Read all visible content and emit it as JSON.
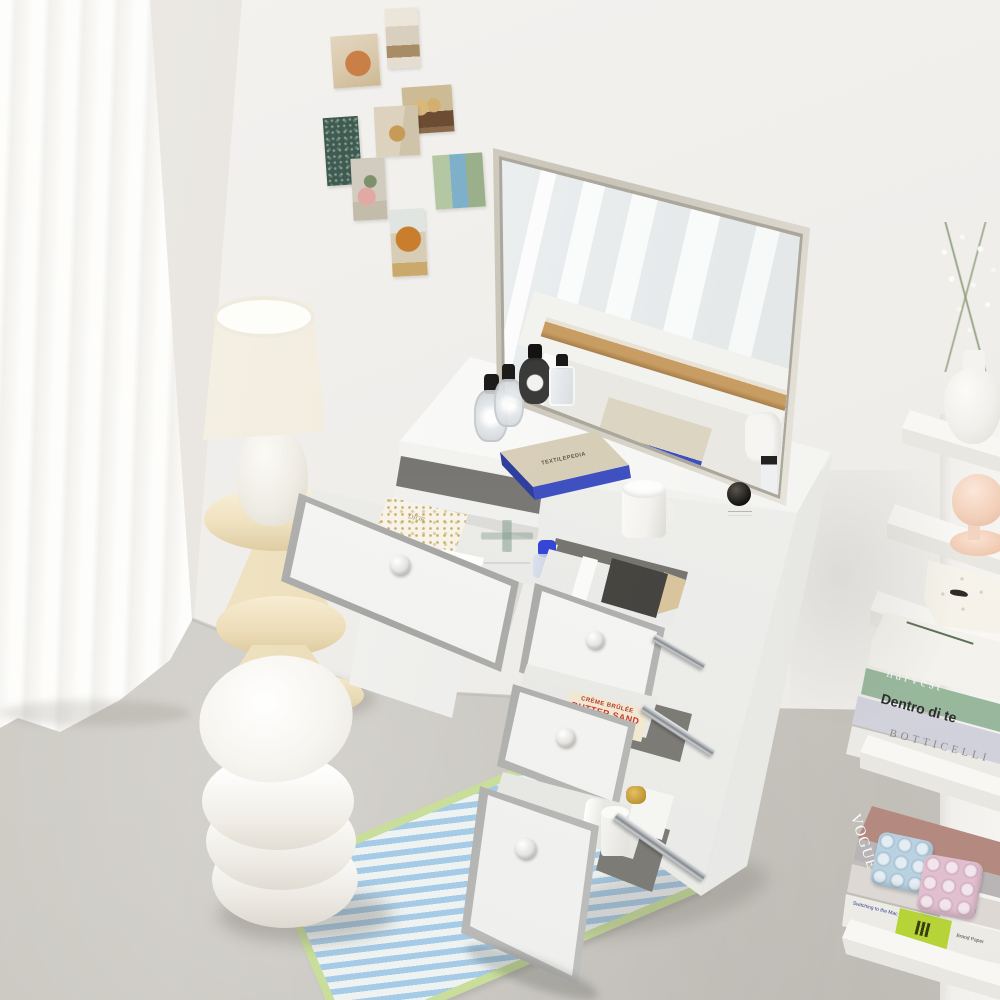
{
  "subject": "bright room corner with white vanity dressing table, tilted mirror, four open drawers, boucle stool, cream lamp on pedestal side table, striped rug and white wall shelf with books",
  "palette": {
    "wall": "#f1efec",
    "wall_left": "#e8e5e1",
    "floor": "#ccc9c2",
    "curtain": "#fbfaf8",
    "desk_white": "#f7f7f5",
    "chrome_trim": "#b0b1af",
    "drawer_slot_dark": "#76756f",
    "pedestal_cream": "#f0e5c6",
    "rug_blue": "#a6cbe6",
    "rug_green": "#c8de9a",
    "page_edge_blue": "#3f51c0",
    "candle_lid_green": "#34534a",
    "bottle_cap_black": "#1c1b19",
    "vogue_gray": "#c7c2c4",
    "lime_band": "#b6d438",
    "mushroom_peach": "#f4d9c6",
    "tin_text_red": "#c8372a"
  },
  "postcards": [
    {
      "name": "citrus-food-card"
    },
    {
      "name": "interior-room-card"
    },
    {
      "name": "puppies-wagon-card"
    },
    {
      "name": "teddy-door-card"
    },
    {
      "name": "dark-foliage-card"
    },
    {
      "name": "pink-pot-plant-card"
    },
    {
      "name": "garden-pool-collage-card"
    },
    {
      "name": "autumn-tree-card"
    }
  ],
  "desk": {
    "book_title": "TEXTILEPEDIA"
  },
  "drawers": {
    "drawer1_items": {
      "gift_box_label": "DIOR",
      "card_monogram": "H"
    },
    "drawer3_tin": {
      "line1": "CRÈME BRÛLÉE",
      "line2": "BUTTER SAND"
    }
  },
  "shelf": {
    "upper_books": [
      {
        "title": "harvest",
        "color": "#9cbda0"
      },
      {
        "title": "Dentro di te",
        "color": "#dadae3"
      },
      {
        "title": "BOTTICELLI",
        "color": "#f4f3f0"
      }
    ],
    "vogue_masthead": "VOGUE",
    "vogue_spine": "VOGUE",
    "small_book_title": "Switching to the Mac",
    "small_book_tag": "Brand Paper"
  }
}
